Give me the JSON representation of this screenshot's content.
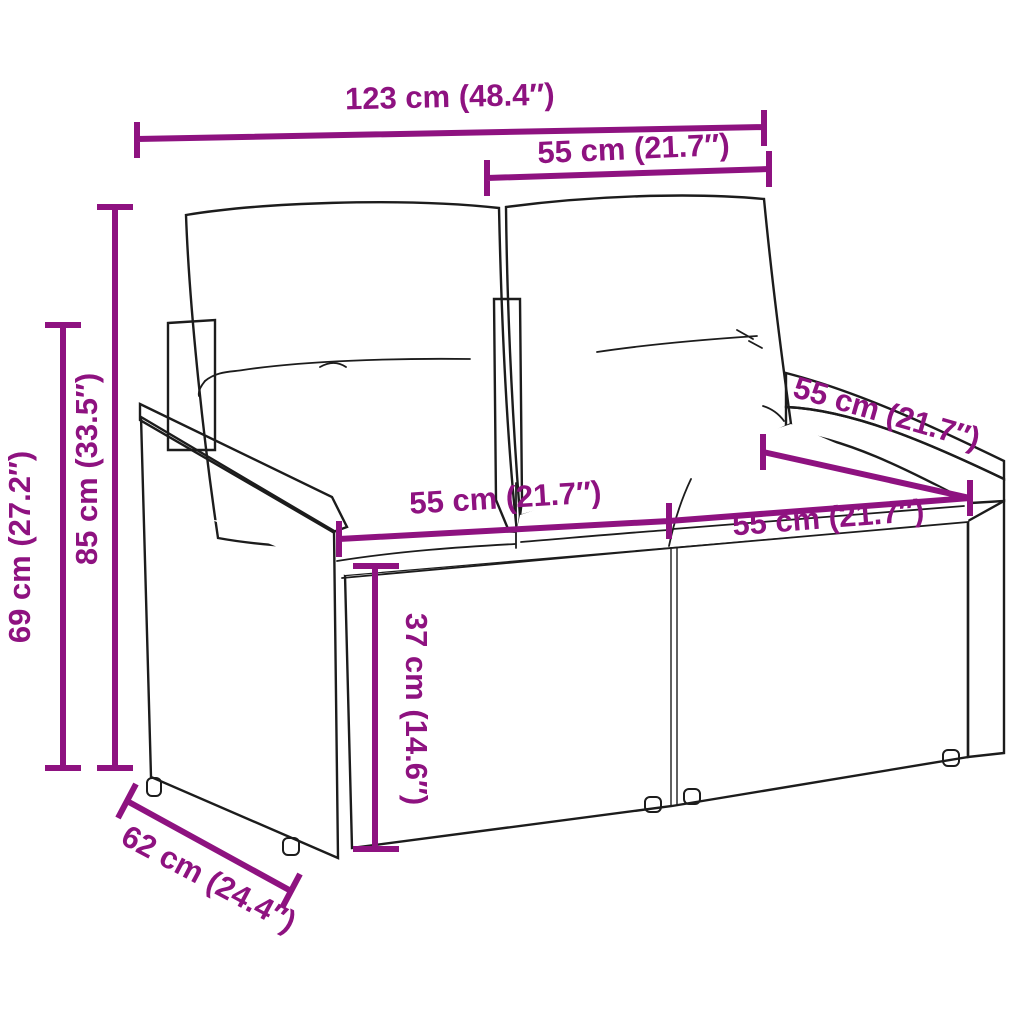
{
  "diagram": {
    "figure": "wicker-garden-bench-with-cushions-line-art",
    "accent_color": "#8E1280",
    "line_color": "#1c1c1c",
    "measurements": [
      {
        "id": "overall-width",
        "label": "123 cm (48.4″)"
      },
      {
        "id": "back-cushion-width",
        "label": "55 cm (21.7″)"
      },
      {
        "id": "back-height",
        "label": "85 cm (33.5″)"
      },
      {
        "id": "armrest-height",
        "label": "69 cm (27.2″)"
      },
      {
        "id": "seat-width-left",
        "label": "55 cm (21.7″)"
      },
      {
        "id": "seat-depth",
        "label": "55 cm (21.7″)"
      },
      {
        "id": "seat-width-right",
        "label": "55 cm (21.7″)"
      },
      {
        "id": "seat-height",
        "label": "37 cm (14.6″)"
      },
      {
        "id": "overall-depth",
        "label": "62 cm (24.4″)"
      }
    ]
  }
}
